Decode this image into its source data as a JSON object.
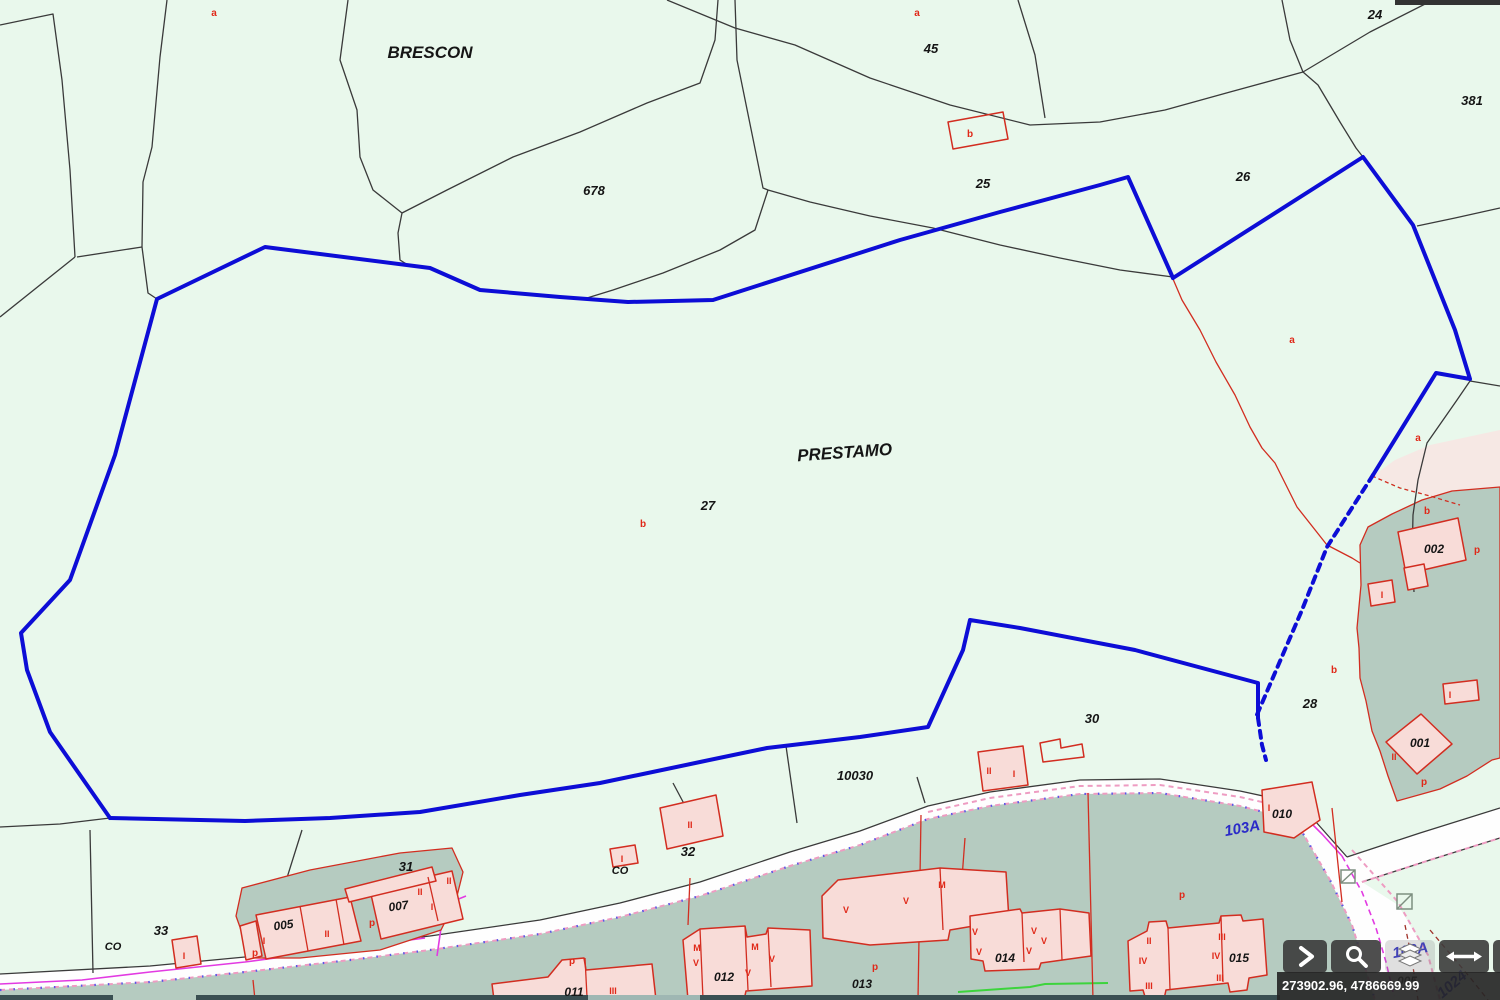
{
  "app": {
    "title": "Cadastral map viewer"
  },
  "colors": {
    "parcel_fill": "#e9f8ec",
    "urban_fill": "#b5cbc0",
    "building_fill": "#f8dcd8",
    "road_fill": "#fefefe",
    "boundary_blue": "#0d0dd6",
    "line_black": "#3a3a3a",
    "line_red": "#d22d20",
    "label_red": "#e02818",
    "label_blue": "#2b2bc8",
    "magenta": "#e23ae2",
    "pink_dash": "#ee9cc2",
    "green_line": "#3cd43c",
    "toolbar_bg": "rgba(59,59,59,0.9)",
    "statusbar_bg": "rgba(38,38,38,0.92)",
    "statusbar_text": "#ffffff"
  },
  "map": {
    "labels_black": [
      {
        "t": "BRESCON",
        "x": 430,
        "y": 58,
        "s": 17,
        "r": 0
      },
      {
        "t": "PRESTAMO",
        "x": 845,
        "y": 458,
        "s": 17,
        "r": -4
      },
      {
        "t": "678",
        "x": 594,
        "y": 195,
        "s": 13,
        "r": 0
      },
      {
        "t": "45",
        "x": 931,
        "y": 53,
        "s": 13,
        "r": 0
      },
      {
        "t": "25",
        "x": 983,
        "y": 188,
        "s": 13,
        "r": 0
      },
      {
        "t": "26",
        "x": 1243,
        "y": 181,
        "s": 13,
        "r": 0
      },
      {
        "t": "24",
        "x": 1375,
        "y": 19,
        "s": 13,
        "r": 0
      },
      {
        "t": "381",
        "x": 1472,
        "y": 105,
        "s": 13,
        "r": 0
      },
      {
        "t": "27",
        "x": 708,
        "y": 510,
        "s": 13,
        "r": 0
      },
      {
        "t": "30",
        "x": 1092,
        "y": 723,
        "s": 13,
        "r": 0
      },
      {
        "t": "10030",
        "x": 855,
        "y": 780,
        "s": 13,
        "r": 0
      },
      {
        "t": "28",
        "x": 1310,
        "y": 708,
        "s": 13,
        "r": 0
      },
      {
        "t": "31",
        "x": 406,
        "y": 871,
        "s": 13,
        "r": 0
      },
      {
        "t": "32",
        "x": 688,
        "y": 856,
        "s": 13,
        "r": 0
      },
      {
        "t": "33",
        "x": 161,
        "y": 935,
        "s": 13,
        "r": 0
      },
      {
        "t": "CO",
        "x": 113,
        "y": 950,
        "s": 11,
        "r": 0
      },
      {
        "t": "CO",
        "x": 620,
        "y": 874,
        "s": 11,
        "r": 0
      },
      {
        "t": "002",
        "x": 1434,
        "y": 553,
        "s": 12,
        "r": 0
      },
      {
        "t": "001",
        "x": 1420,
        "y": 747,
        "s": 12,
        "r": 0
      },
      {
        "t": "010",
        "x": 1282,
        "y": 818,
        "s": 12,
        "r": 0
      },
      {
        "t": "005",
        "x": 284,
        "y": 929,
        "s": 12,
        "r": -8
      },
      {
        "t": "007",
        "x": 399,
        "y": 910,
        "s": 12,
        "r": -8
      },
      {
        "t": "011",
        "x": 574,
        "y": 996,
        "s": 12,
        "r": 0
      },
      {
        "t": "012",
        "x": 724,
        "y": 981,
        "s": 12,
        "r": 0
      },
      {
        "t": "013",
        "x": 862,
        "y": 988,
        "s": 12,
        "r": 0
      },
      {
        "t": "014",
        "x": 1005,
        "y": 962,
        "s": 12,
        "r": 0
      },
      {
        "t": "015",
        "x": 1239,
        "y": 962,
        "s": 12,
        "r": 0
      },
      {
        "t": "005",
        "x": 1407,
        "y": 985,
        "s": 12,
        "r": 0
      }
    ],
    "labels_red": [
      {
        "t": "a",
        "x": 214,
        "y": 16,
        "s": 10
      },
      {
        "t": "a",
        "x": 917,
        "y": 16,
        "s": 10
      },
      {
        "t": "b",
        "x": 970,
        "y": 137,
        "s": 10
      },
      {
        "t": "a",
        "x": 1292,
        "y": 343,
        "s": 10
      },
      {
        "t": "a",
        "x": 1418,
        "y": 441,
        "s": 10
      },
      {
        "t": "b",
        "x": 643,
        "y": 527,
        "s": 10
      },
      {
        "t": "b",
        "x": 1427,
        "y": 514,
        "s": 10
      },
      {
        "t": "b",
        "x": 1334,
        "y": 673,
        "s": 10
      },
      {
        "t": "p",
        "x": 1477,
        "y": 553,
        "s": 10
      },
      {
        "t": "p",
        "x": 1424,
        "y": 785,
        "s": 10
      },
      {
        "t": "I",
        "x": 1382,
        "y": 598,
        "s": 9
      },
      {
        "t": "II",
        "x": 1394,
        "y": 760,
        "s": 9
      },
      {
        "t": "I",
        "x": 1450,
        "y": 698,
        "s": 9
      },
      {
        "t": "I",
        "x": 1269,
        "y": 811,
        "s": 9
      },
      {
        "t": "p",
        "x": 1182,
        "y": 898,
        "s": 10
      },
      {
        "t": "p",
        "x": 875,
        "y": 970,
        "s": 10
      },
      {
        "t": "p",
        "x": 572,
        "y": 964,
        "s": 10
      },
      {
        "t": "p",
        "x": 255,
        "y": 956,
        "s": 10
      },
      {
        "t": "p",
        "x": 372,
        "y": 926,
        "s": 10
      },
      {
        "t": "I",
        "x": 264,
        "y": 944,
        "s": 9
      },
      {
        "t": "II",
        "x": 327,
        "y": 937,
        "s": 9
      },
      {
        "t": "II",
        "x": 420,
        "y": 895,
        "s": 9
      },
      {
        "t": "I",
        "x": 432,
        "y": 910,
        "s": 9
      },
      {
        "t": "II",
        "x": 449,
        "y": 884,
        "s": 9
      },
      {
        "t": "I",
        "x": 622,
        "y": 862,
        "s": 9
      },
      {
        "t": "II",
        "x": 690,
        "y": 828,
        "s": 9
      },
      {
        "t": "I",
        "x": 184,
        "y": 959,
        "s": 9
      },
      {
        "t": "II",
        "x": 989,
        "y": 774,
        "s": 9
      },
      {
        "t": "I",
        "x": 1014,
        "y": 777,
        "s": 9
      },
      {
        "t": "III",
        "x": 613,
        "y": 994,
        "s": 9
      },
      {
        "t": "M",
        "x": 942,
        "y": 888,
        "s": 9
      },
      {
        "t": "V",
        "x": 846,
        "y": 913,
        "s": 9
      },
      {
        "t": "V",
        "x": 906,
        "y": 904,
        "s": 9
      },
      {
        "t": "M",
        "x": 697,
        "y": 951,
        "s": 9
      },
      {
        "t": "V",
        "x": 696,
        "y": 966,
        "s": 9
      },
      {
        "t": "M",
        "x": 755,
        "y": 950,
        "s": 9
      },
      {
        "t": "V",
        "x": 748,
        "y": 976,
        "s": 9
      },
      {
        "t": "V",
        "x": 772,
        "y": 962,
        "s": 9
      },
      {
        "t": "V",
        "x": 975,
        "y": 935,
        "s": 9
      },
      {
        "t": "V",
        "x": 1034,
        "y": 934,
        "s": 9
      },
      {
        "t": "V",
        "x": 1044,
        "y": 944,
        "s": 9
      },
      {
        "t": "V",
        "x": 979,
        "y": 955,
        "s": 9
      },
      {
        "t": "V",
        "x": 1029,
        "y": 954,
        "s": 9
      },
      {
        "t": "II",
        "x": 1149,
        "y": 944,
        "s": 9
      },
      {
        "t": "III",
        "x": 1222,
        "y": 940,
        "s": 9
      },
      {
        "t": "IV",
        "x": 1143,
        "y": 964,
        "s": 9
      },
      {
        "t": "IV",
        "x": 1216,
        "y": 959,
        "s": 9
      },
      {
        "t": "III",
        "x": 1220,
        "y": 981,
        "s": 9
      },
      {
        "t": "III",
        "x": 1149,
        "y": 989,
        "s": 9
      }
    ],
    "labels_blue": [
      {
        "t": "103A",
        "x": 1243,
        "y": 833,
        "s": 15,
        "r": -10
      },
      {
        "t": "103A",
        "x": 1411,
        "y": 955,
        "s": 15,
        "r": -10
      },
      {
        "t": "1024",
        "x": 1455,
        "y": 988,
        "s": 15,
        "r": -40
      }
    ]
  },
  "toolbar": {
    "buttons": [
      {
        "name": "next-button",
        "icon": "chevron-right-icon"
      },
      {
        "name": "search-button",
        "icon": "search-icon"
      },
      {
        "name": "layers-button",
        "icon": "layers-icon"
      },
      {
        "name": "pan-horizontal-button",
        "icon": "resize-horizontal-icon"
      },
      {
        "name": "partial-button",
        "icon": "partial-button-icon"
      }
    ]
  },
  "statusbar": {
    "coordinates": "273902.96, 4786669.99"
  }
}
